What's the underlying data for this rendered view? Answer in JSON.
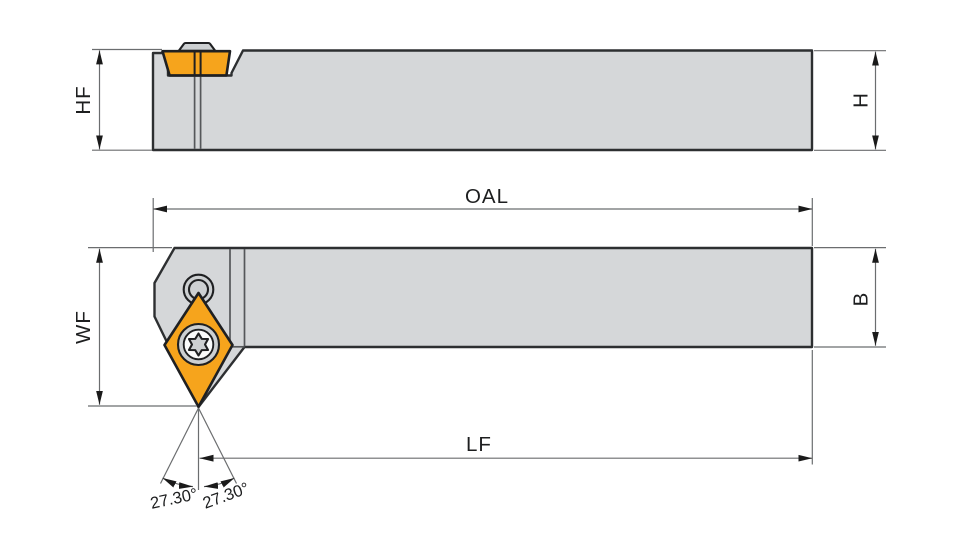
{
  "drawing": {
    "dimension_labels": {
      "hf": "HF",
      "h": "H",
      "oal": "OAL",
      "wf": "WF",
      "b": "B",
      "lf": "LF"
    },
    "angle_labels": {
      "left": "27.30°",
      "right": "27.30°"
    },
    "colors": {
      "background": "#ffffff",
      "body": "#d5d7d9",
      "body_outline": "#2d2f31",
      "insert": "#f6a41c",
      "insert_outline": "#1f2022",
      "screw": "#cdd0d2",
      "screw_inner": "#fafbfb",
      "detail_line": "#55575a",
      "dim_line": "#6b6d6f",
      "arrow": "#1a1a1a",
      "text": "#1d1e1f"
    }
  }
}
